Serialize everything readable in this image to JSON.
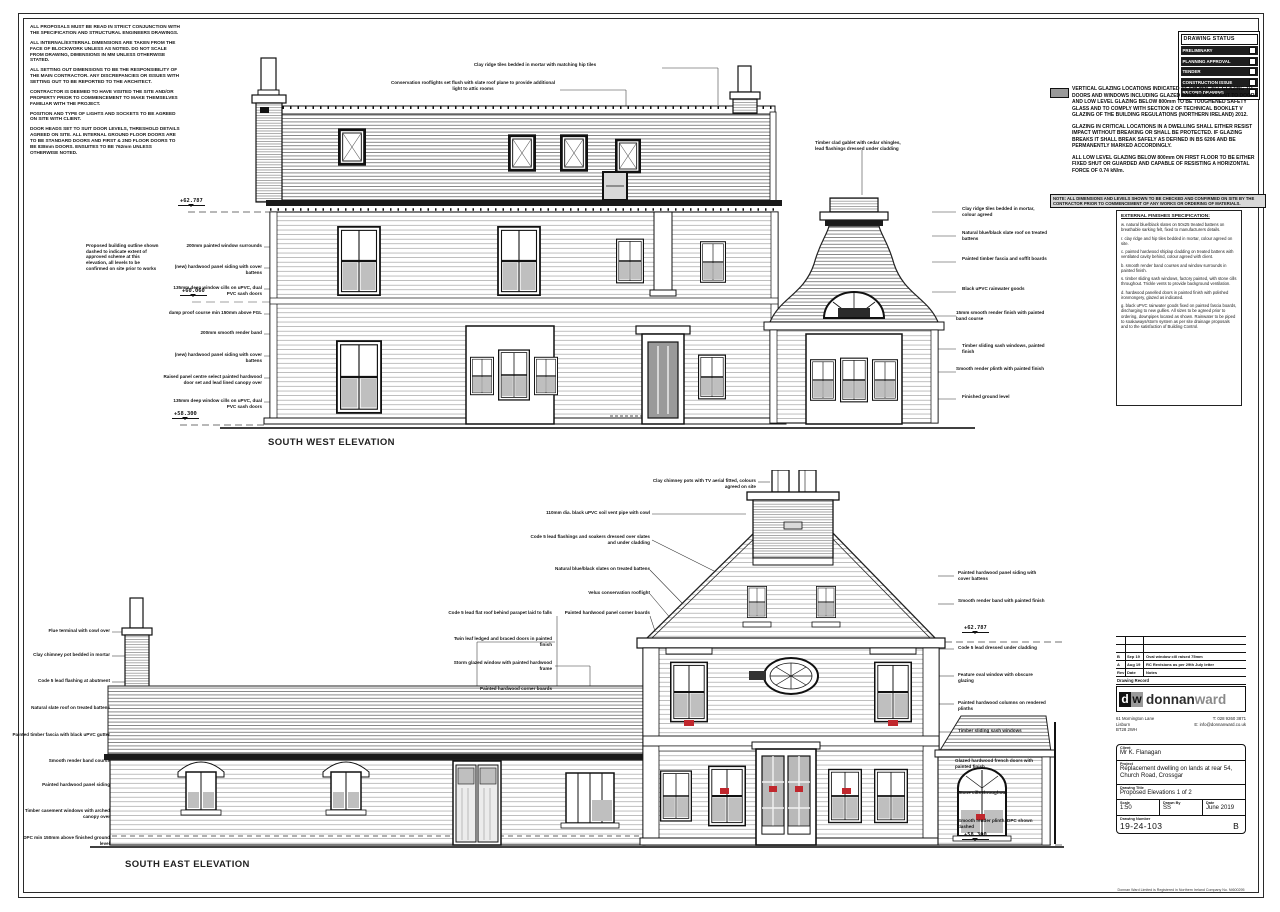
{
  "sheet": {
    "background": "#ffffff",
    "line_color": "#1a1a1a",
    "glazing_mark_color": "#c0272d"
  },
  "notes_top_left": {
    "paragraphs": [
      "ALL PROPOSALS MUST BE READ IN STRICT CONJUNCTION WITH THE SPECIFICATION AND STRUCTURAL ENGINEERS DRAWINGS.",
      "ALL INTERNAL/EXTERNAL DIMENSIONS ARE TAKEN FROM THE FACE OF BLOCKWORK UNLESS AS NOTED. DO NOT SCALE FROM DRAWING, DIMENSIONS IN MM UNLESS OTHERWISE STATED.",
      "ALL SETTING OUT DIMENSIONS TO BE THE RESPONSIBILITY OF THE MAIN CONTRACTOR. ANY DISCREPANCIES OR ISSUES WITH SETTING OUT TO BE REPORTED TO THE ARCHITECT.",
      "CONTRACTOR IS DEEMED TO HAVE VISITED THE SITE AND/OR PROPERTY PRIOR TO COMMENCEMENT TO MAKE THEMSELVES FAMILIAR WITH THE PROJECT.",
      "POSITION AND TYPE OF LIGHTS AND SOCKETS TO BE AGREED ON SITE WITH CLIENT.",
      "DOOR HEADS SET TO SUIT DOOR LEVELS, THRESHOLD DETAILS AGREED ON SITE. ALL INTERNAL GROUND FLOOR DOORS ARE TO BE STANDARD DOORS AND FIRST & 2ND FLOOR DOORS TO BE 838mm DOORS. ENSUITES TO BE 762mm UNLESS OTHERWISE NOTED."
    ]
  },
  "drawing_status": {
    "title": "DRAWING STATUS",
    "rows": [
      "PRELIMINARY",
      "PLANNING APPROVAL",
      "TENDER",
      "CONSTRUCTION ISSUE",
      "RECORD DRAWING"
    ]
  },
  "glazing_note": {
    "legend_label": "VERTICAL GLAZING LOCATIONS INDICATED AS",
    "paragraphs": [
      "VERTICAL GLAZING LOCATIONS INDICATED AS SHOWN. ALL GLAZING TO DOORS AND WINDOWS INCLUDING GLAZED PANELS ADJACENT TO DOORS AND LOW LEVEL GLAZING BELOW 800mm TO BE TOUGHENED SAFETY GLASS AND TO COMPLY WITH SECTION 2 OF TECHNICAL BOOKLET V GLAZING OF THE BUILDING REGULATIONS (NORTHERN IRELAND) 2012.",
      "GLAZING IN CRITICAL LOCATIONS IN A DWELLING SHALL EITHER RESIST IMPACT WITHOUT BREAKING OR SHALL BE PROTECTED. IF GLAZING BREAKS IT SHALL BREAK SAFELY AS DEFINED IN BS 6206 AND BE PERMANENTLY MARKED ACCORDINGLY.",
      "ALL LOW LEVEL GLAZING BELOW 800mm ON FIRST FLOOR TO BE EITHER FIXED SHUT OR GUARDED AND CAPABLE OF RESISTING A HORIZONTAL FORCE OF 0.74 kN/m."
    ],
    "banner": "NOTE: ALL DIMENSIONS AND LEVELS SHOWN TO BE CHECKED AND CONFIRMED ON SITE BY THE CONTRACTOR PRIOR TO COMMENCEMENT OF ANY WORKS OR ORDERING OF MATERIALS."
  },
  "spec_notes": {
    "heading": "EXTERNAL FINISHES SPECIFICATION:",
    "items": [
      "w. natural blue/black slates on 50x25 treated battens on breathable sarking felt, fixed to manufacturers details.",
      "r. clay ridge and hip tiles bedded in mortar, colour agreed on site.",
      "c. painted hardwood shiplap cladding on treated battens with ventilated cavity behind, colour agreed with client.",
      "b. smooth render band courses and window surrounds in painted finish.",
      "s. timber sliding sash windows, factory painted, with stone cills throughout. Trickle vents to provide background ventilation.",
      "d. hardwood panelled doors in painted finish with polished ironmongery, glazed as indicated.",
      "g. black uPVC rainwater goods fixed on painted fascia boards, discharging to new gullies. All sizes to be agreed prior to ordering, downpipes located as shown. Rainwater to be piped to soakaways/storm system as per site drainage proposals and to the satisfaction of Building Control."
    ]
  },
  "elevations": {
    "south_west": {
      "title": "SOUTH WEST ELEVATION",
      "levels": [
        {
          "v": "+62.787",
          "x": 178,
          "y": 198
        },
        {
          "v": "+60.060",
          "x": 180,
          "y": 288
        },
        {
          "v": "+58.300",
          "x": 172,
          "y": 411
        }
      ],
      "callouts": [
        {
          "t": "Proposed building outline shown dashed to indicate extent of approved scheme at this elevation, all levels to be confirmed on site prior to works",
          "x": 86,
          "y": 243,
          "w": 76,
          "a": "l"
        },
        {
          "t": "200mm painted window surrounds",
          "x": 168,
          "y": 243,
          "w": 94,
          "a": "r"
        },
        {
          "t": "(new) hardwood panel siding with cover battens",
          "x": 168,
          "y": 264,
          "w": 94,
          "a": "r"
        },
        {
          "t": "135mm deep window cills on uPVC, dual PVC sash doors",
          "x": 168,
          "y": 285,
          "w": 94,
          "a": "r"
        },
        {
          "t": "damp proof course min 150mm above FGL",
          "x": 168,
          "y": 310,
          "w": 94,
          "a": "r"
        },
        {
          "t": "200mm smooth render band",
          "x": 168,
          "y": 330,
          "w": 94,
          "a": "r"
        },
        {
          "t": "(new) hardwood panel siding with cover battens",
          "x": 168,
          "y": 352,
          "w": 94,
          "a": "r"
        },
        {
          "t": "Raised panel centre select painted hardwood door set and lead lined canopy over",
          "x": 152,
          "y": 374,
          "w": 110,
          "a": "r"
        },
        {
          "t": "135mm deep window cills on uPVC, dual PVC sash doors",
          "x": 168,
          "y": 398,
          "w": 94,
          "a": "r"
        },
        {
          "t": "Clay ridge tiles bedded in mortar with matching hip tiles",
          "x": 455,
          "y": 62,
          "w": 160,
          "a": "c"
        },
        {
          "t": "Conservation rooflights set flush with slate roof plane to provide additional light to attic rooms",
          "x": 388,
          "y": 80,
          "w": 170,
          "a": "c"
        },
        {
          "t": "Timber clad gablet with cedar shingles, lead flashings dressed under cladding",
          "x": 815,
          "y": 140,
          "w": 95,
          "a": "l"
        },
        {
          "t": "Clay ridge tiles bedded in mortar, colour agreed",
          "x": 962,
          "y": 206,
          "w": 85,
          "a": "l"
        },
        {
          "t": "Natural blue/black slate roof on treated battens",
          "x": 962,
          "y": 230,
          "w": 85,
          "a": "l"
        },
        {
          "t": "Painted timber fascia and soffit boards",
          "x": 962,
          "y": 256,
          "w": 85,
          "a": "l"
        },
        {
          "t": "Black uPVC rainwater goods",
          "x": 962,
          "y": 286,
          "w": 85,
          "a": "l"
        },
        {
          "t": "15mm smooth render finish with painted band course",
          "x": 956,
          "y": 310,
          "w": 92,
          "a": "l"
        },
        {
          "t": "Timber sliding sash windows, painted finish",
          "x": 962,
          "y": 343,
          "w": 85,
          "a": "l"
        },
        {
          "t": "Smooth render plinth with painted finish",
          "x": 956,
          "y": 366,
          "w": 92,
          "a": "l"
        },
        {
          "t": "Finished ground level",
          "x": 962,
          "y": 394,
          "w": 85,
          "a": "l"
        }
      ]
    },
    "south_east": {
      "title": "SOUTH EAST ELEVATION",
      "levels": [
        {
          "v": "+62.787",
          "x": 962,
          "y": 625
        },
        {
          "v": "+58.300",
          "x": 962,
          "y": 832
        }
      ],
      "callouts": [
        {
          "t": "Clay chimney pots with TV aerial fitted, colours agreed on site",
          "x": 638,
          "y": 478,
          "w": 118,
          "a": "r"
        },
        {
          "t": "110mm dia. black uPVC soil vent pipe with cowl",
          "x": 530,
          "y": 510,
          "w": 120,
          "a": "r"
        },
        {
          "t": "Code 5 lead flashings and soakers dressed over slates and under cladding",
          "x": 528,
          "y": 534,
          "w": 122,
          "a": "r"
        },
        {
          "t": "Natural blue/black slates on treated battens",
          "x": 538,
          "y": 566,
          "w": 112,
          "a": "r"
        },
        {
          "t": "Velux conservation rooflight",
          "x": 540,
          "y": 590,
          "w": 110,
          "a": "r"
        },
        {
          "t": "Painted hardwood panel corner boards",
          "x": 536,
          "y": 610,
          "w": 114,
          "a": "r"
        },
        {
          "t": "Code 5 lead flat roof behind parapet laid to falls",
          "x": 440,
          "y": 610,
          "w": 112,
          "a": "r"
        },
        {
          "t": "Twin leaf ledged and braced doors in painted finish",
          "x": 445,
          "y": 636,
          "w": 107,
          "a": "r"
        },
        {
          "t": "Storm glazed window with painted hardwood frame",
          "x": 445,
          "y": 660,
          "w": 107,
          "a": "r"
        },
        {
          "t": "Painted hardwood corner boards",
          "x": 449,
          "y": 686,
          "w": 103,
          "a": "r"
        },
        {
          "t": "Flue terminal with cowl over",
          "x": 18,
          "y": 628,
          "w": 92,
          "a": "r"
        },
        {
          "t": "Clay chimney pot bedded in mortar",
          "x": 12,
          "y": 652,
          "w": 98,
          "a": "r"
        },
        {
          "t": "Code 5 lead flashing at abutment",
          "x": 12,
          "y": 678,
          "w": 98,
          "a": "r"
        },
        {
          "t": "Natural slate roof on treated battens",
          "x": 12,
          "y": 705,
          "w": 98,
          "a": "r"
        },
        {
          "t": "Painted timber fascia with black uPVC gutter",
          "x": 12,
          "y": 732,
          "w": 98,
          "a": "r"
        },
        {
          "t": "Smooth render band course",
          "x": 12,
          "y": 758,
          "w": 98,
          "a": "r"
        },
        {
          "t": "Painted hardwood panel siding",
          "x": 12,
          "y": 782,
          "w": 98,
          "a": "r"
        },
        {
          "t": "Timber casement windows with arched canopy over",
          "x": 12,
          "y": 808,
          "w": 98,
          "a": "r"
        },
        {
          "t": "DPC min 150mm above finished ground level",
          "x": 12,
          "y": 835,
          "w": 98,
          "a": "r"
        },
        {
          "t": "Painted hardwood panel siding with cover battens",
          "x": 958,
          "y": 570,
          "w": 88,
          "a": "l"
        },
        {
          "t": "Smooth render band with painted finish",
          "x": 958,
          "y": 598,
          "w": 88,
          "a": "l"
        },
        {
          "t": "Code 5 lead dressed under cladding",
          "x": 958,
          "y": 645,
          "w": 88,
          "a": "l"
        },
        {
          "t": "Feature oval window with obscure glazing",
          "x": 958,
          "y": 672,
          "w": 88,
          "a": "l"
        },
        {
          "t": "Painted hardwood columns on rendered plinths",
          "x": 958,
          "y": 700,
          "w": 88,
          "a": "l"
        },
        {
          "t": "Timber sliding sash windows",
          "x": 958,
          "y": 728,
          "w": 88,
          "a": "l"
        },
        {
          "t": "Glazed hardwood french doors with painted finish",
          "x": 955,
          "y": 758,
          "w": 90,
          "a": "l"
        },
        {
          "t": "Stone cills throughout",
          "x": 958,
          "y": 790,
          "w": 88,
          "a": "l"
        },
        {
          "t": "Smooth render plinth, DPC shown dashed",
          "x": 958,
          "y": 818,
          "w": 88,
          "a": "l"
        }
      ]
    }
  },
  "revision_table": {
    "rows": [
      [
        "",
        "",
        ""
      ],
      [
        "",
        "",
        ""
      ],
      [
        "B",
        "Sep 19",
        "Oval window cill raised 75mm"
      ],
      [
        "A",
        "Aug 19",
        "RC Revisions as per 29th July letter"
      ],
      [
        "Rev",
        "Date",
        "Notes"
      ]
    ],
    "footer": "Drawing Record"
  },
  "brand": {
    "tile_d": "d",
    "tile_w": "w",
    "name_primary": "donnan",
    "name_secondary": "ward",
    "address_left": "61 Mornington Lane\nLisburn\nBT28 2WH",
    "phone": "T: 028 9260 3871",
    "email": "E: info@donnanward.co.uk"
  },
  "title_block": {
    "client_label": "Client",
    "client_value": "Mr K. Flanagan",
    "project_label": "Project",
    "project_value": "Replacement dwelling on lands at rear 54, Church Road, Crossgar",
    "drawing_title_label": "Drawing Title",
    "drawing_title_value": "Proposed Elevations 1 of 2",
    "scale_label": "Scale",
    "scale_value": "1:50",
    "drawn_by_label": "Drawn By",
    "drawn_by_value": "SS",
    "date_label": "Date",
    "date_value": "June 2019",
    "drawing_number_label": "Drawing Number",
    "drawing_number_value": "19-24-103",
    "revision_label": "Number",
    "revision_value": "B"
  },
  "footer_note": "Donnan Ward Limited is Registered in Northern Ireland Company No. NI600295"
}
